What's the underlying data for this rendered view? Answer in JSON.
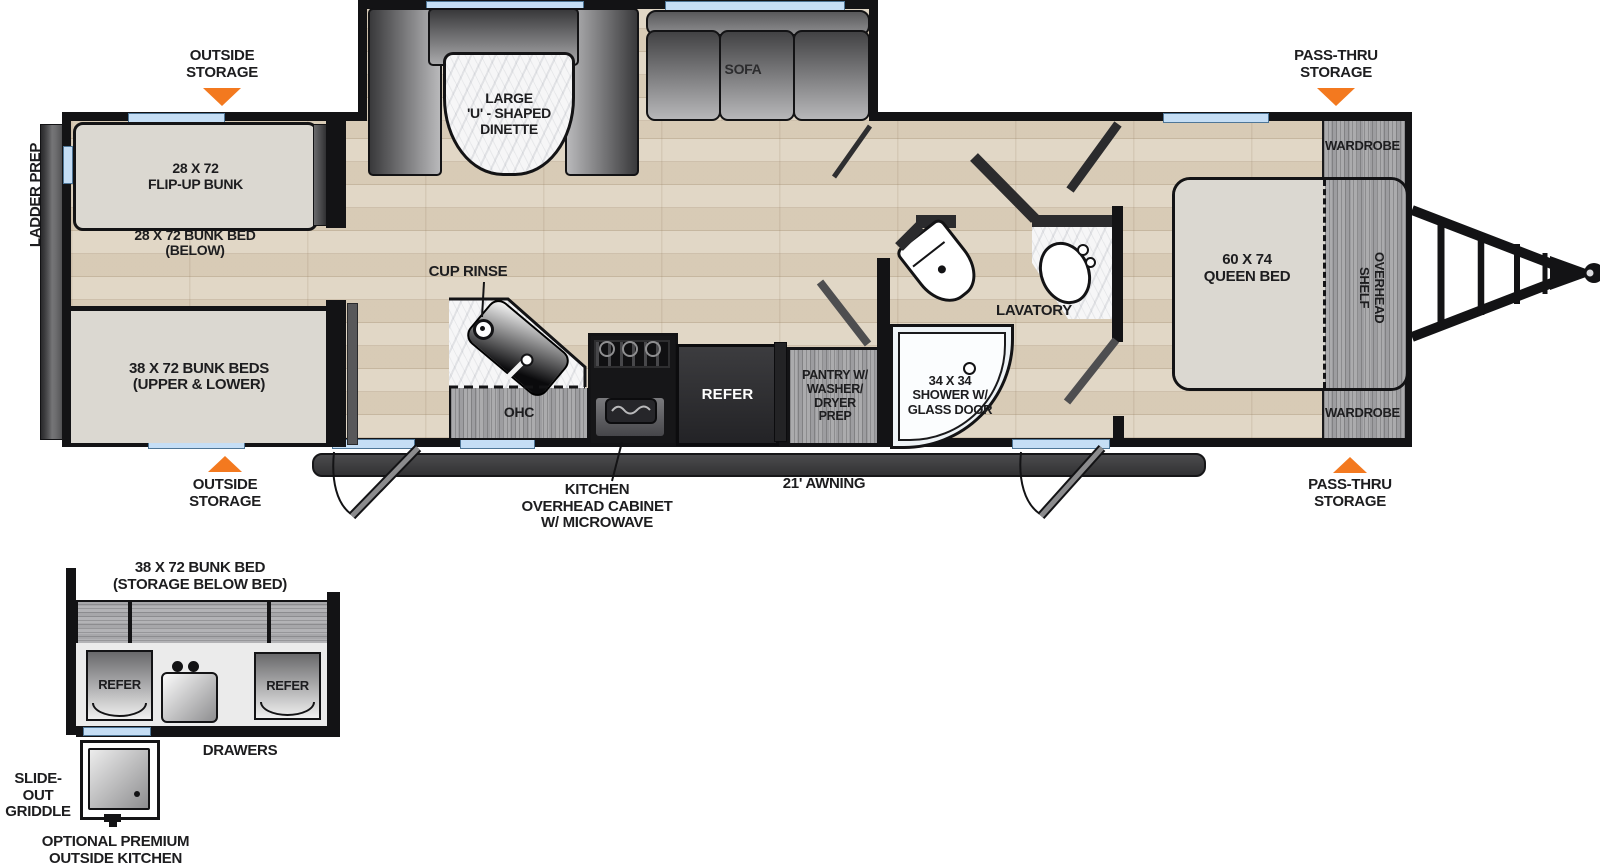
{
  "colors": {
    "accent_orange": "#F3791F",
    "window_blue": "#C5DEF5",
    "wall_black": "#131315",
    "floor_wood": "#DED3C0",
    "cabinet_gray": "#9D9DA0",
    "furniture_beige": "#DBD8D1"
  },
  "exterior": {
    "ladder_prep": "LADDER PREP",
    "awning": "21' AWNING"
  },
  "callouts": {
    "outside_storage_top": "OUTSIDE\nSTORAGE",
    "pass_thru_top": "PASS-THRU\nSTORAGE",
    "outside_storage_bottom": "OUTSIDE\nSTORAGE",
    "pass_thru_bottom": "PASS-THRU\nSTORAGE",
    "cup_rinse": "CUP RINSE",
    "kitchen_ohc": "KITCHEN\nOVERHEAD CABINET\nW/ MICROWAVE"
  },
  "rooms": {
    "bunk": {
      "flip_up": "28 X 72\nFLIP-UP BUNK",
      "below": "28 X 72 BUNK BED\n(BELOW)",
      "upper_lower": "38 X 72 BUNK BEDS\n(UPPER & LOWER)"
    },
    "living": {
      "dinette": "LARGE\n'U' - SHAPED\nDINETTE",
      "sofa": "SOFA"
    },
    "kitchen": {
      "ohc": "OHC",
      "refer": "REFER",
      "pantry": "PANTRY W/\nWASHER/\nDRYER\nPREP"
    },
    "bath": {
      "shower": "34 X 34\nSHOWER W/\nGLASS DOOR",
      "lavatory": "LAVATORY"
    },
    "bedroom": {
      "queen_bed": "60 X 74\nQUEEN BED",
      "overhead_shelf": "OVERHEAD\nSHELF",
      "wardrobe_top": "WARDROBE",
      "wardrobe_bottom": "WARDROBE"
    }
  },
  "outside_kitchen": {
    "title": "38 X 72 BUNK BED\n(STORAGE BELOW BED)",
    "refer_left": "REFER",
    "refer_right": "REFER",
    "drawers": "DRAWERS",
    "griddle": "SLIDE-OUT\nGRIDDLE",
    "caption": "OPTIONAL PREMIUM\nOUTSIDE KITCHEN"
  }
}
